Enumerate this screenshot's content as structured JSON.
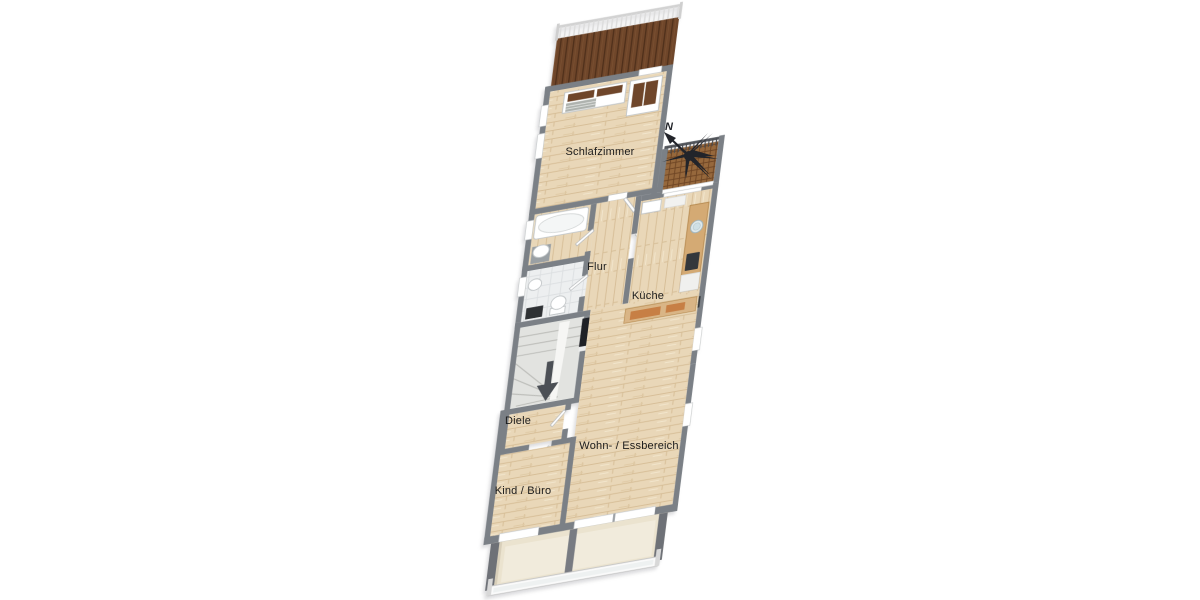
{
  "title": "Wohnung Grundriss (floor plan)",
  "rooms": [
    {
      "id": "schlafzimmer",
      "label": "Schlafzimmer"
    },
    {
      "id": "flur",
      "label": "Flur"
    },
    {
      "id": "kueche",
      "label": "Küche"
    },
    {
      "id": "wohn-essbereich",
      "label": "Wohn- / Essbereich"
    },
    {
      "id": "diele",
      "label": "Diele"
    },
    {
      "id": "kind-buero",
      "label": "Kind / Büro"
    }
  ],
  "compass": {
    "label": "N"
  },
  "features": [
    "balkon-oben-holzdielen",
    "balkon-kueche-lattenrost",
    "terrasse-unten-glasgelaender",
    "badewanne",
    "waschbecken",
    "wc",
    "treppe-abwaerts",
    "kuechenzeile-mit-spuele-und-kochfeld",
    "bett-und-schrank",
    "eingangstuer"
  ],
  "colors": {
    "wall": "#7b8086",
    "wallDark": "#6e7177",
    "wood": "#e9d7b8",
    "woodLine": "#d6bd96",
    "darkWood": "#6f462a",
    "darkWoodLine": "#4e2f1a",
    "lattice": "#96683c",
    "latticeLine": "#6e4524",
    "tile": "#edeff0",
    "tileLine": "#dcdfe1",
    "terrace": "#ebe3cf",
    "terraceEdge": "#d8cfba",
    "stairs": "#e2e3e0",
    "counter": "#d4aa74",
    "bench": "#c77f45",
    "cooktop": "#33373c",
    "fixtureStroke": "#c2c6c8",
    "doorLeaf": "#fdfdfd",
    "entranceDoor": "#1f2126",
    "arrow": "#4b4f55",
    "compass": "#22242a",
    "label": "#1b1b1b"
  }
}
